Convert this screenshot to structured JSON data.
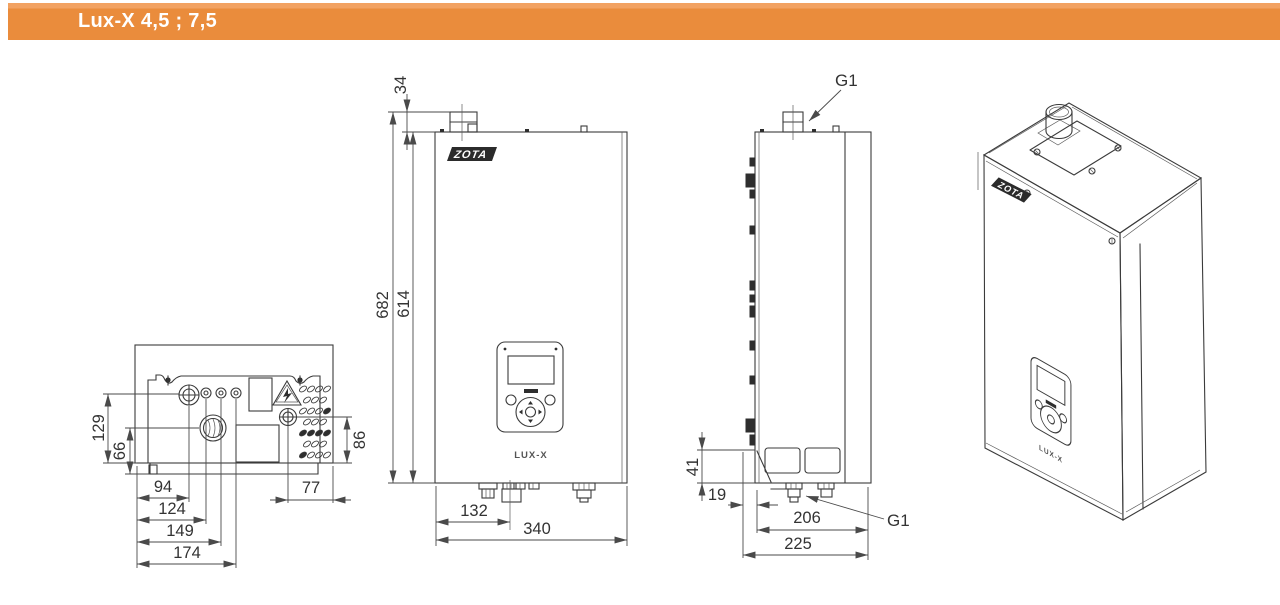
{
  "header": {
    "title": "Lux-X 4,5 ; 7,5"
  },
  "colors": {
    "accent": "#ea8c3c",
    "accent_light": "#f2a262",
    "line": "#3b3b3b",
    "text": "#333333",
    "title_text": "#ffffff"
  },
  "views": {
    "bottom": {
      "dims": {
        "v129": "129",
        "v66": "66",
        "v86": "86",
        "h94": "94",
        "h124": "124",
        "h149": "149",
        "h174": "174",
        "h77": "77"
      }
    },
    "front": {
      "logo": "ZOTA",
      "model": "LUX-X",
      "dims": {
        "d34": "34",
        "d682": "682",
        "d614": "614",
        "d132": "132",
        "d340": "340"
      }
    },
    "side": {
      "dims": {
        "d41": "41",
        "d19": "19",
        "d206": "206",
        "d225": "225"
      },
      "labels": {
        "g1_top": "G1",
        "g1_bottom": "G1"
      }
    },
    "iso": {
      "logo": "ZOTA",
      "model": "LUX-X"
    }
  }
}
